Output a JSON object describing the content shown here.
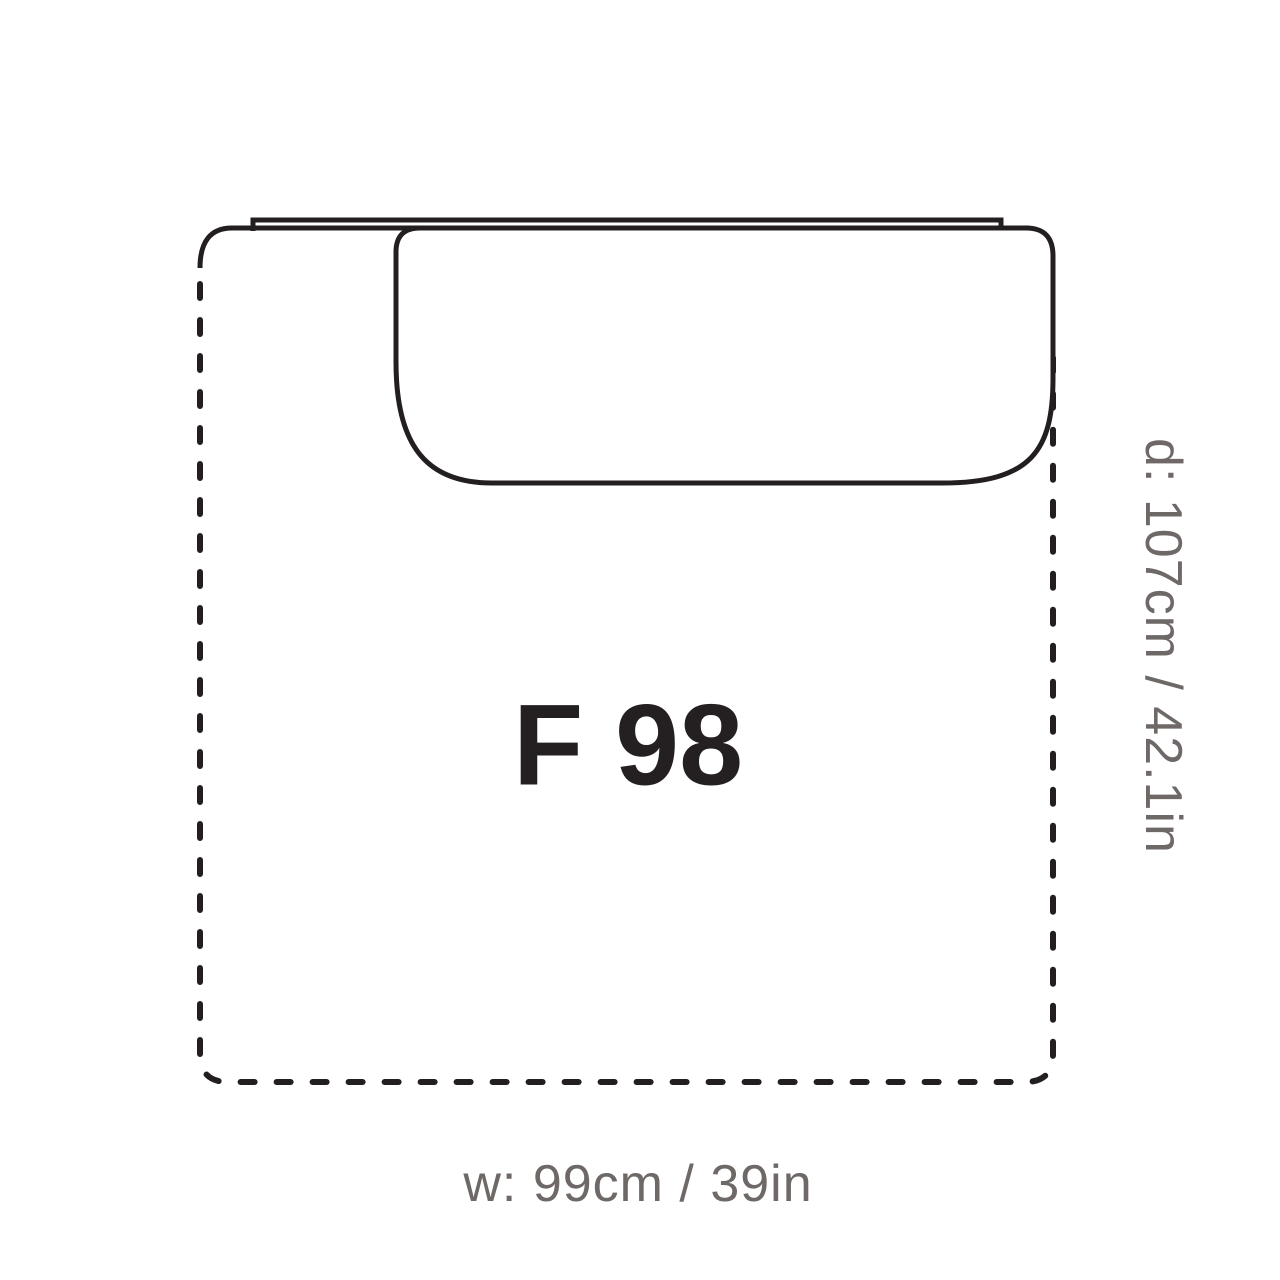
{
  "module": {
    "name": "F 98",
    "width_label": "w: 99cm / 39in",
    "depth_label": "d: 107cm / 42.1in"
  },
  "colors": {
    "line": "#231f20",
    "label": "#242021",
    "dimension": "#6e6867"
  }
}
